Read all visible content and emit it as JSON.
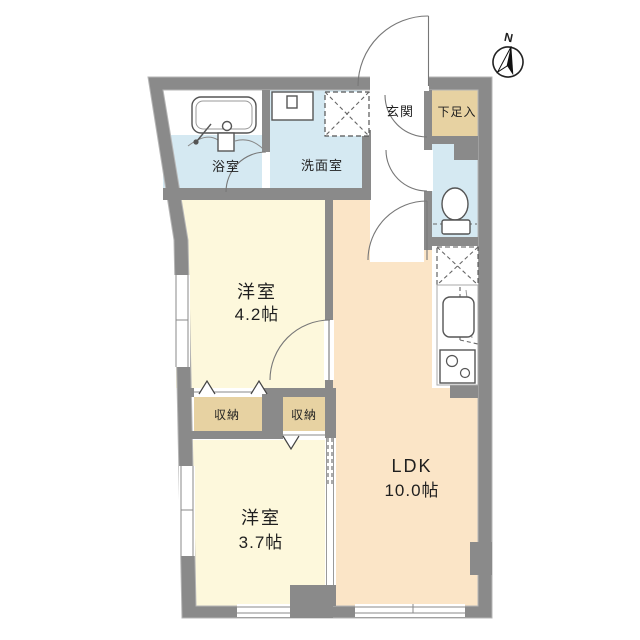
{
  "compass": {
    "north_label": "N"
  },
  "labels": {
    "bathroom": "浴室",
    "washroom": "洗面室",
    "entrance": "玄関",
    "shoe_cabinet": "下足入",
    "western_room_a": "洋室",
    "western_room_a_size": "4.2帖",
    "closet_a": "収納",
    "closet_b": "収納",
    "western_room_b": "洋室",
    "western_room_b_size": "3.7帖",
    "ldk": "LDK",
    "ldk_size": "10.0帖"
  },
  "colors": {
    "wall": "#8a8a8a",
    "wet_area_floor": "#d5e9f2",
    "room_floor": "#fdf8dc",
    "ldk_floor": "#fbe5c7",
    "storage_floor": "#e7d2a2",
    "background": "#ffffff"
  }
}
